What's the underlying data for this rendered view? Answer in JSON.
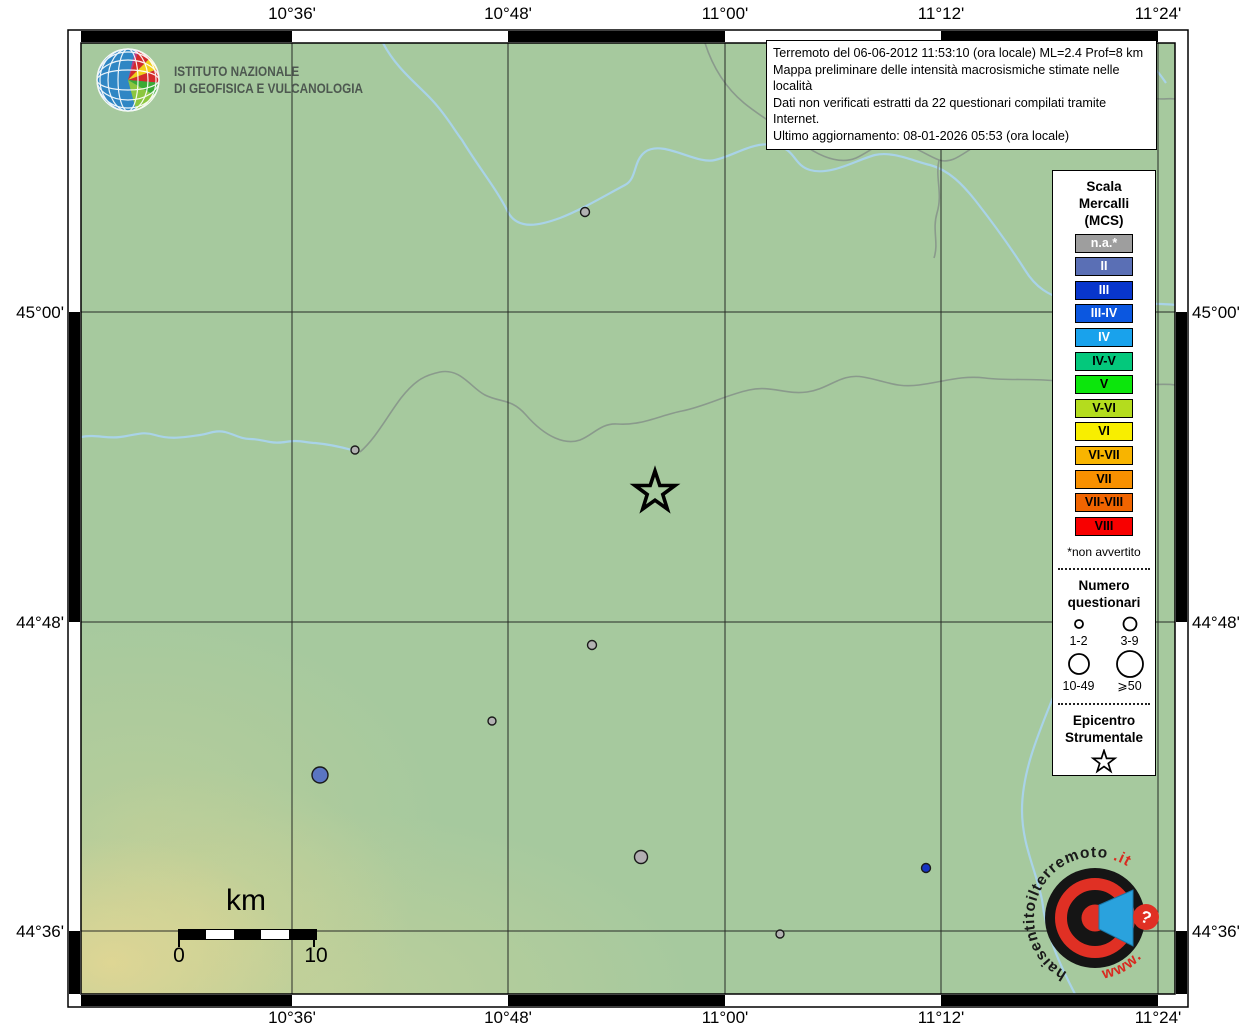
{
  "colors": {
    "map_bg": "#a6c99e",
    "river": "#a9d3e8",
    "boundary": "#8a9a8c",
    "grid": "#1a1a1a",
    "accent_red": "#d9291f",
    "megaphone_blue": "#2aa2dd"
  },
  "axis": {
    "top": [
      "10°36'",
      "10°48'",
      "11°00'",
      "11°12'",
      "11°24'"
    ],
    "bottom": [
      "10°36'",
      "10°48'",
      "11°00'",
      "11°12'",
      "11°24'"
    ],
    "left": [
      "45°00'",
      "44°48'",
      "44°36'"
    ],
    "right": [
      "45°00'",
      "44°48'",
      "44°36'"
    ]
  },
  "info_box": {
    "lines": [
      "Terremoto del 06-06-2012 11:53:10 (ora locale) ML=2.4 Prof=8 km",
      "Mappa preliminare delle intensità macrosismiche stimate nelle località",
      "Dati non verificati estratti da 22 questionari compilati tramite Internet.",
      "Ultimo aggiornamento: 08-01-2026 05:53 (ora locale)"
    ]
  },
  "ingv": {
    "name_line1": "ISTITUTO NAZIONALE",
    "name_line2": "DI GEOFISICA E VULCANOLOGIA"
  },
  "legend": {
    "title_lines": [
      "Scala",
      "Mercalli",
      "(MCS)"
    ],
    "items": [
      {
        "label": "n.a.*",
        "color": "#9e9e9e",
        "text": "#ffffff"
      },
      {
        "label": "II",
        "color": "#5a6fb5",
        "text": "#ffffff"
      },
      {
        "label": "III",
        "color": "#0836cc",
        "text": "#ffffff"
      },
      {
        "label": "III-IV",
        "color": "#0b57e0",
        "text": "#ffffff"
      },
      {
        "label": "IV",
        "color": "#19a2ec",
        "text": "#ffffff"
      },
      {
        "label": "IV-V",
        "color": "#04c87c",
        "text": "#000000"
      },
      {
        "label": "V",
        "color": "#0ce60c",
        "text": "#000000"
      },
      {
        "label": "V-VI",
        "color": "#b4dc1e",
        "text": "#000000"
      },
      {
        "label": "VI",
        "color": "#f8ee00",
        "text": "#000000"
      },
      {
        "label": "VI-VII",
        "color": "#f8b400",
        "text": "#000000"
      },
      {
        "label": "VII",
        "color": "#f89000",
        "text": "#000000"
      },
      {
        "label": "VII-VIII",
        "color": "#f06400",
        "text": "#000000"
      },
      {
        "label": "VIII",
        "color": "#f80000",
        "text": "#000000"
      }
    ],
    "footnote": "*non avvertito",
    "questionari": {
      "title_lines": [
        "Numero",
        "questionari"
      ],
      "classes": [
        {
          "label": "1-2",
          "r": 4
        },
        {
          "label": "3-9",
          "r": 6.5
        },
        {
          "label": "10-49",
          "r": 10
        },
        {
          "label": "⩾50",
          "r": 13
        }
      ]
    },
    "epicentro": {
      "title_lines": [
        "Epicentro",
        "Strumentale"
      ]
    }
  },
  "scale_bar": {
    "unit": "km",
    "start_label": "0",
    "end_label": "10"
  },
  "watermark": {
    "arc_text": "haisentitoilterremoto",
    "arc_suffix": ".it",
    "www": "www.",
    "question": "?"
  },
  "map": {
    "grid": {
      "vx": [
        211,
        427,
        644,
        860,
        1077
      ],
      "hy": [
        269,
        579,
        888
      ]
    },
    "epicenter": {
      "x": 574,
      "y": 449
    },
    "markers": [
      {
        "x": 504,
        "y": 169,
        "r": 4.5,
        "intensity": "n.a.",
        "color": "#b2b2b2"
      },
      {
        "x": 274,
        "y": 407,
        "r": 4.0,
        "intensity": "n.a.",
        "color": "#b2b2b2"
      },
      {
        "x": 511,
        "y": 602,
        "r": 4.5,
        "intensity": "n.a.",
        "color": "#b2b2b2"
      },
      {
        "x": 411,
        "y": 678,
        "r": 4.0,
        "intensity": "n.a.",
        "color": "#b2b2b2"
      },
      {
        "x": 239,
        "y": 732,
        "r": 8.0,
        "intensity": "II",
        "color": "#5a75c2"
      },
      {
        "x": 560,
        "y": 814,
        "r": 6.5,
        "intensity": "n.a.",
        "color": "#b2aeb2"
      },
      {
        "x": 845,
        "y": 825,
        "r": 4.5,
        "intensity": "III",
        "color": "#1634c4"
      },
      {
        "x": 699,
        "y": 891,
        "r": 4.0,
        "intensity": "n.a.",
        "color": "#b2b2b2"
      }
    ]
  }
}
